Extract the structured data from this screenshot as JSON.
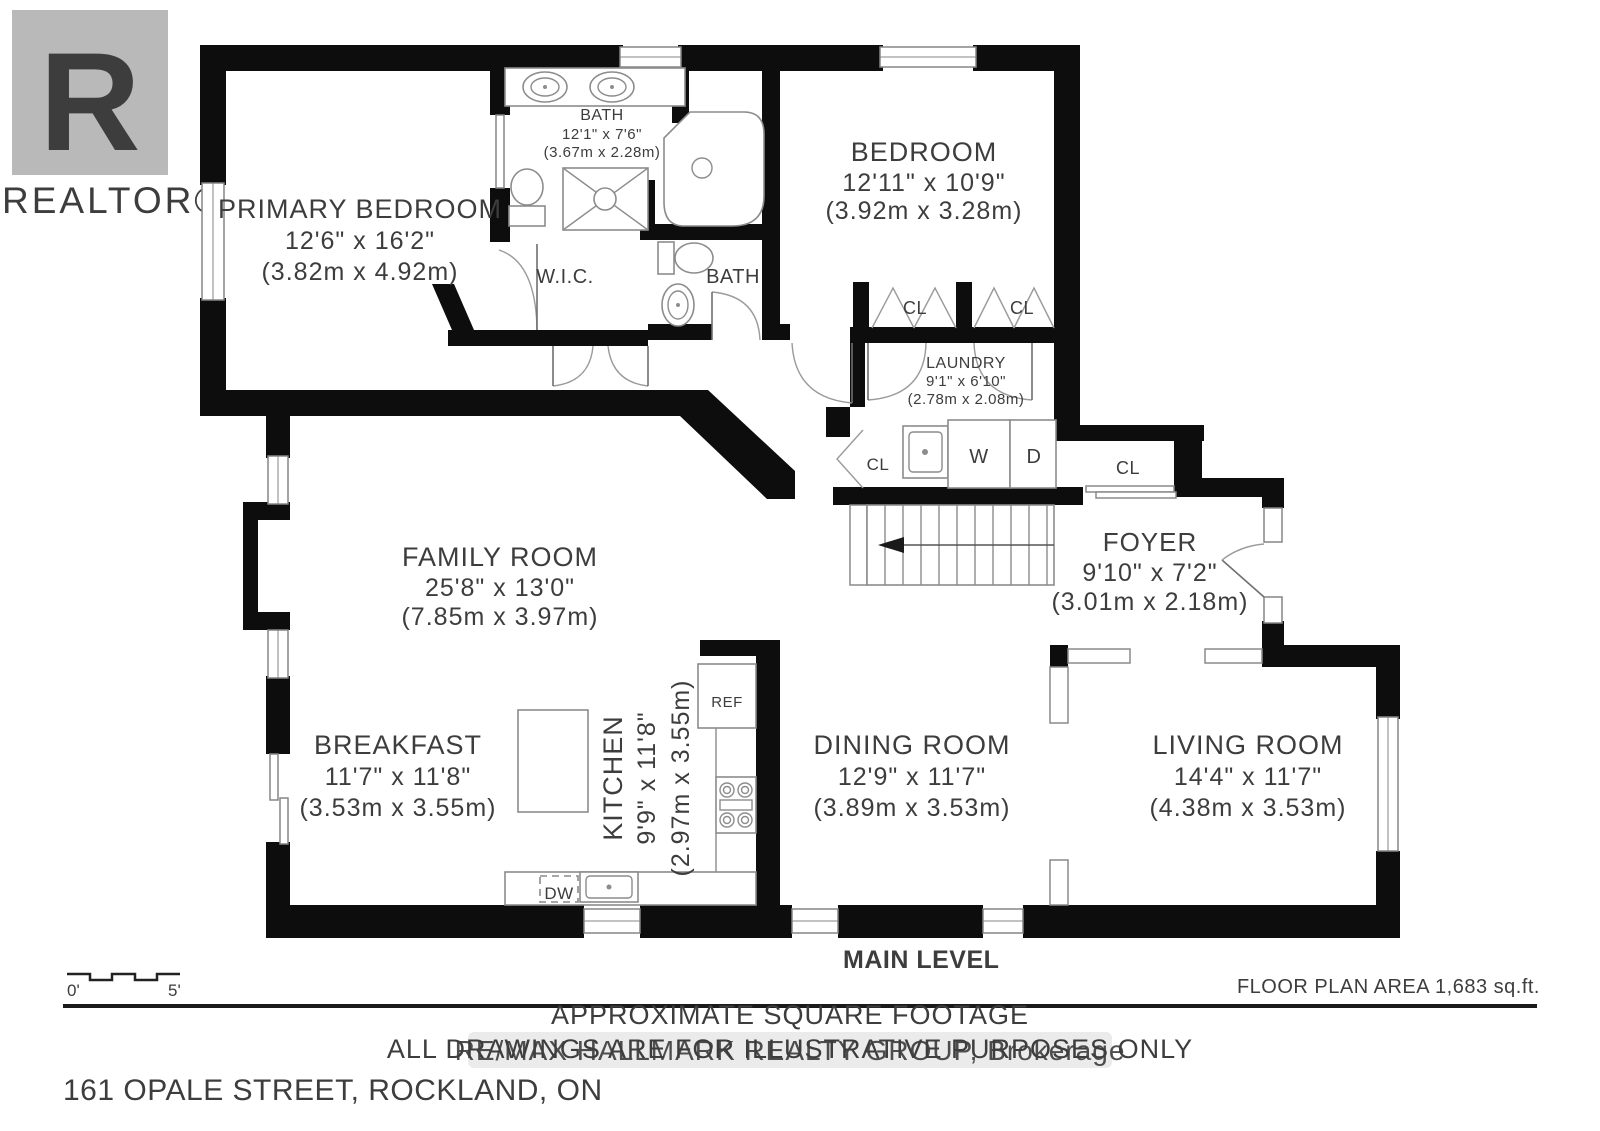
{
  "branding": {
    "logo_letter": "R",
    "logo_text": "REALTOR®"
  },
  "rooms": {
    "primary_bedroom": {
      "name": "PRIMARY BEDROOM",
      "dims": "12'6\" x 16'2\"",
      "metric": "(3.82m x 4.92m)"
    },
    "bath_main": {
      "name": "BATH",
      "dims": "12'1\" x 7'6\"",
      "metric": "(3.67m x 2.28m)"
    },
    "bedroom": {
      "name": "BEDROOM",
      "dims": "12'11\" x 10'9\"",
      "metric": "(3.92m x 3.28m)"
    },
    "wic": {
      "name": "W.I.C."
    },
    "bath_second": {
      "name": "BATH"
    },
    "laundry": {
      "name": "LAUNDRY",
      "dims": "9'1\" x 6'10\"",
      "metric": "(2.78m x 2.08m)"
    },
    "foyer": {
      "name": "FOYER",
      "dims": "9'10\" x 7'2\"",
      "metric": "(3.01m x 2.18m)"
    },
    "family_room": {
      "name": "FAMILY ROOM",
      "dims": "25'8\" x 13'0\"",
      "metric": "(7.85m x 3.97m)"
    },
    "breakfast": {
      "name": "BREAKFAST",
      "dims": "11'7\" x 11'8\"",
      "metric": "(3.53m x 3.55m)"
    },
    "kitchen": {
      "name": "KITCHEN",
      "dims": "9'9\" x 11'8\"",
      "metric": "(2.97m x 3.55m)"
    },
    "dining_room": {
      "name": "DINING ROOM",
      "dims": "12'9\" x 11'7\"",
      "metric": "(3.89m x 3.53m)"
    },
    "living_room": {
      "name": "LIVING ROOM",
      "dims": "14'4\" x 11'7\"",
      "metric": "(4.38m x 3.53m)"
    }
  },
  "labels": {
    "closet": "CL",
    "washer": "W",
    "dryer": "D",
    "fridge": "REF",
    "dishwasher": "DW"
  },
  "footer": {
    "level": "MAIN LEVEL",
    "area": "FLOOR PLAN AREA 1,683 sq.ft.",
    "disclaimer1": "APPROXIMATE SQUARE FOOTAGE",
    "disclaimer2": "ALL DRAWINGS ARE FOR ILLUSTRATIVE PURPOSES ONLY",
    "address": "161 OPALE STREET, ROCKLAND, ON",
    "scale_start": "0'",
    "scale_end": "5'",
    "watermark": "RE/MAX HALLMARK REALTY GROUP, Brokerage"
  },
  "colors": {
    "wall": "#0d0d0d",
    "text": "#3d3d3d",
    "logo_gray": "#b9b9b9",
    "watermark_gray": "#c4c4c4"
  }
}
